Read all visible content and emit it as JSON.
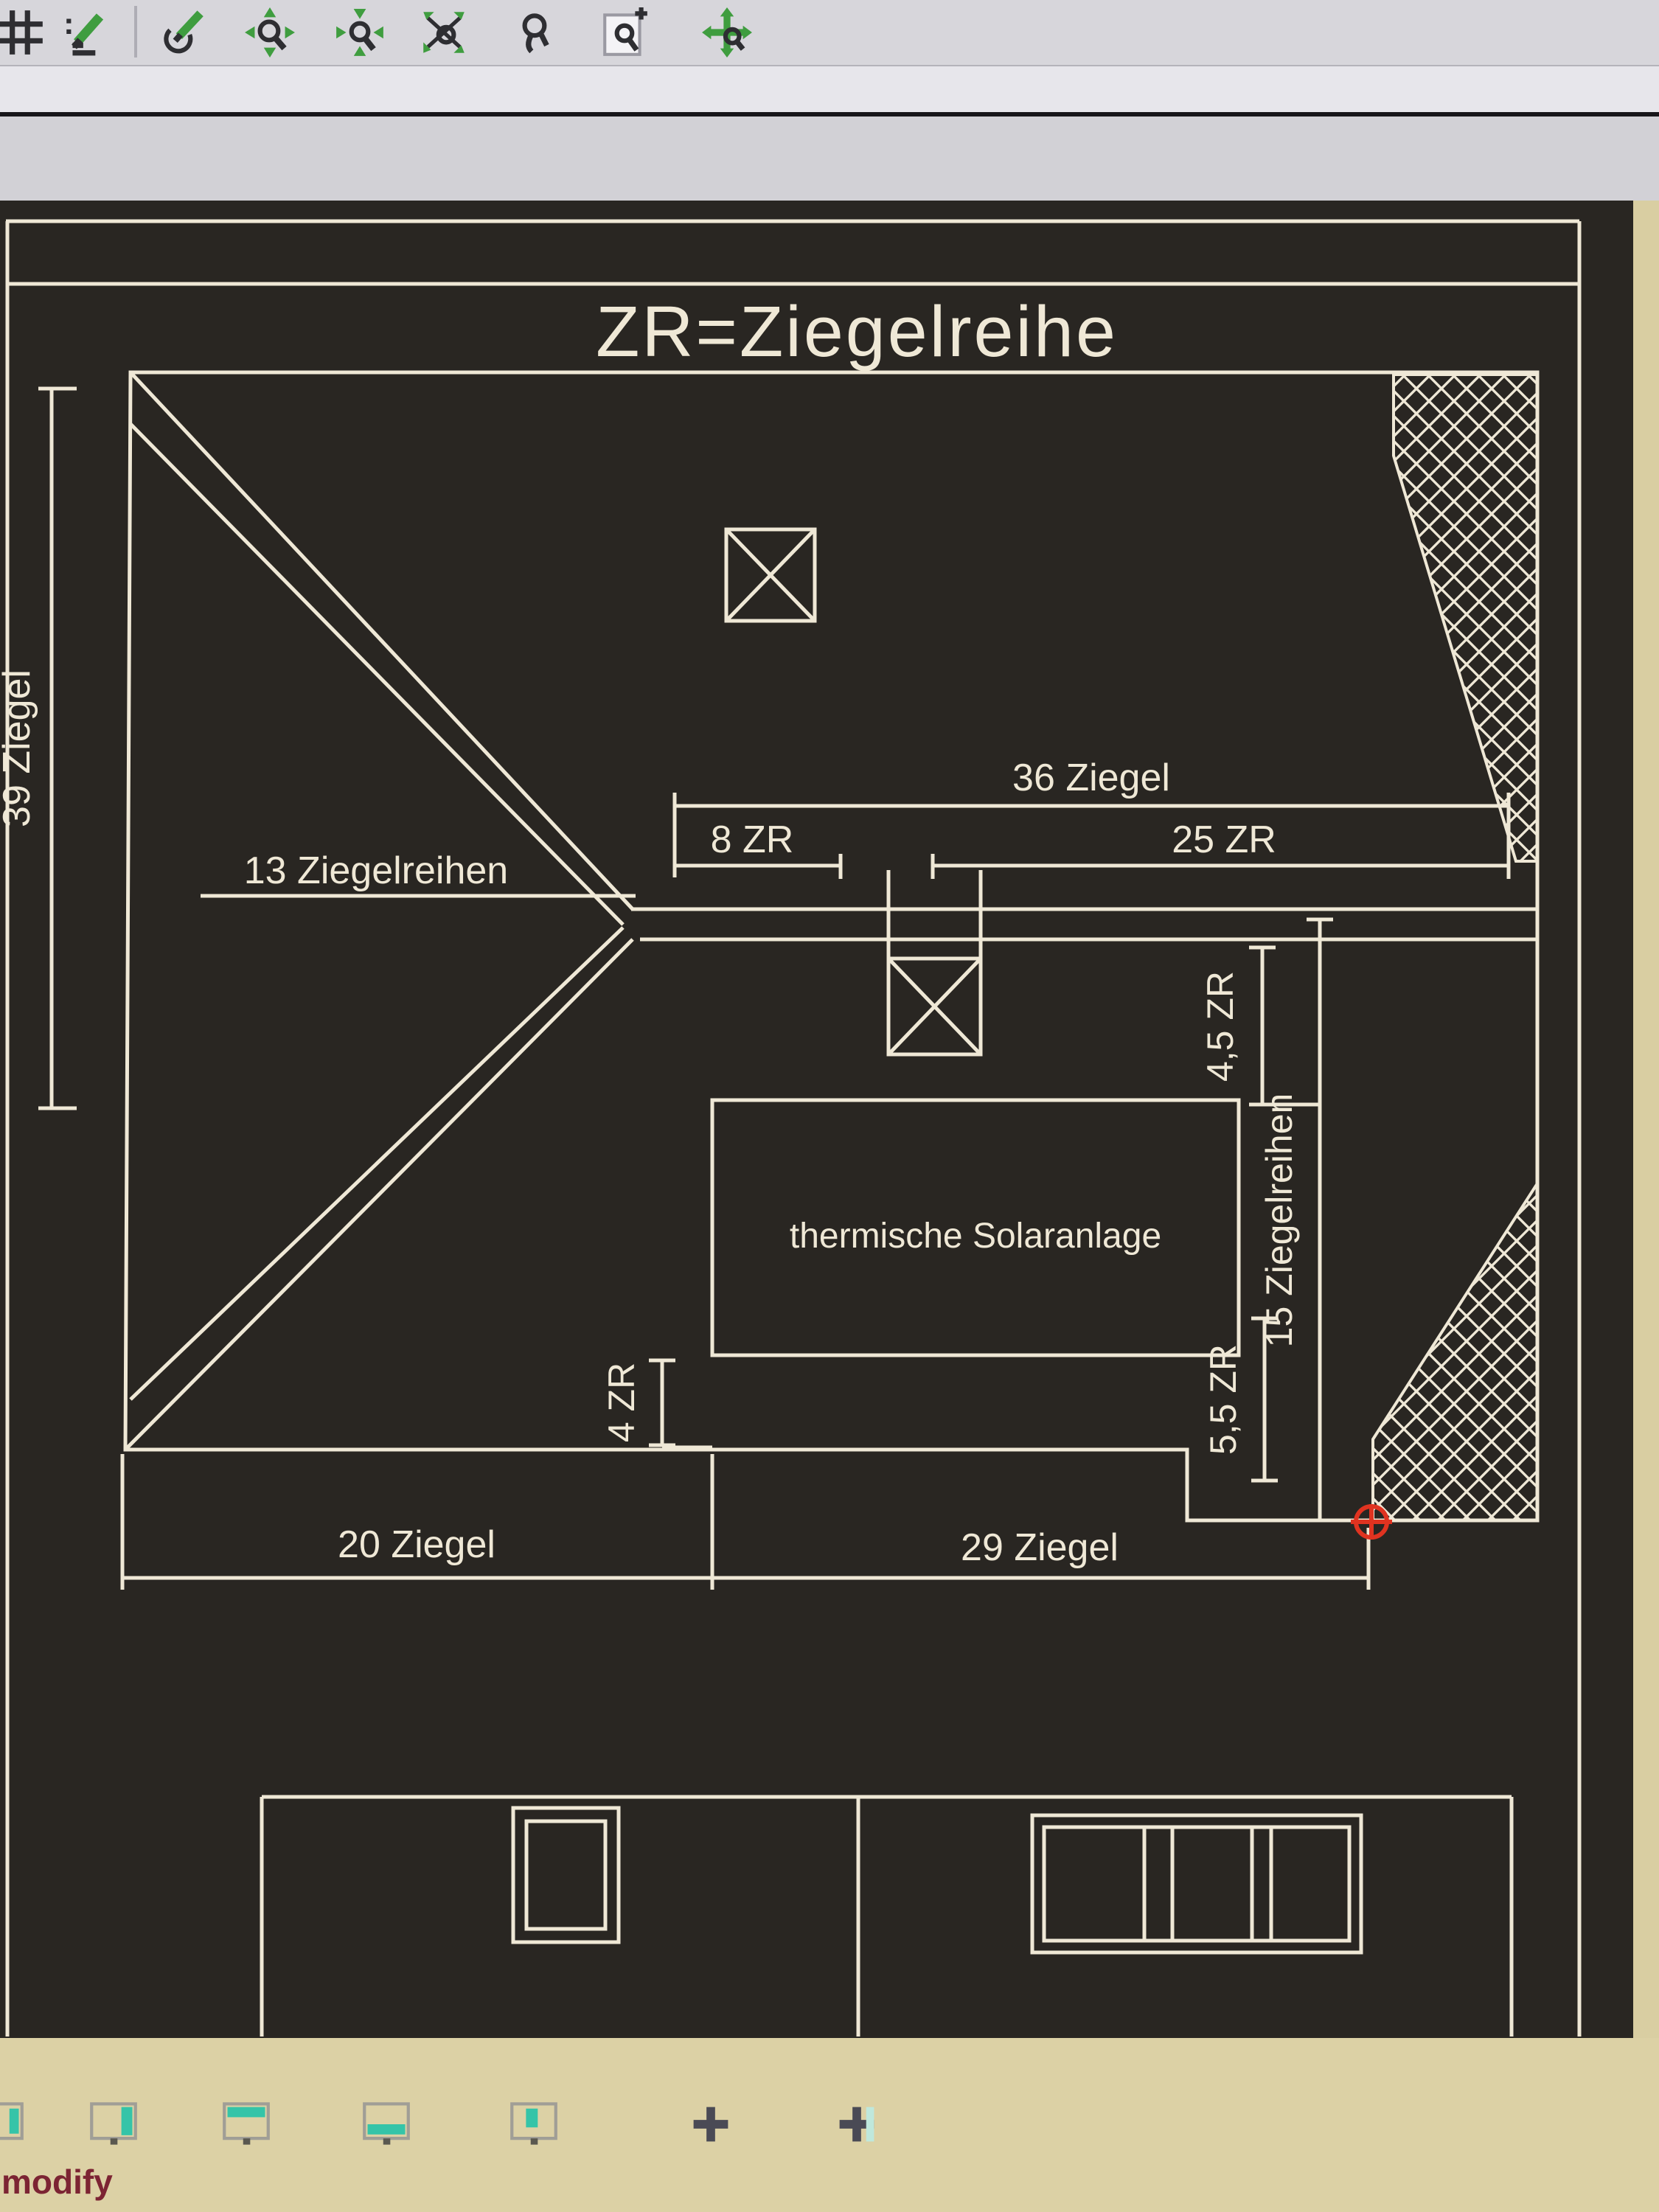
{
  "chrome": {
    "top_toolbar_icons": [
      "grid-icon",
      "sketch-line-icon",
      "pencil-arc-icon",
      "zoom-all-icon",
      "zoom-center-icon",
      "zoom-dynamic-icon",
      "zoom-realtime-icon",
      "zoom-window-icon",
      "pan-zoom-icon"
    ],
    "bottom_dock_icons": [
      "dock-partial-icon",
      "dock-right-icon",
      "dock-top-icon",
      "dock-bottom-icon",
      "dock-float-icon",
      "crosshair-plus-icon",
      "crosshair-plus-icon-2"
    ],
    "status_text": "modify"
  },
  "drawing": {
    "title": "ZR=Ziegelreihe",
    "labels": {
      "left_height": "39 Ziegel",
      "hip_rows": "13 Ziegelreihen",
      "top_width": "36 Ziegel",
      "ridge_left": "8 ZR",
      "ridge_right": "25 ZR",
      "right_upper": "4,5 ZR",
      "right_rows": "15 Ziegelreihen",
      "right_lower": "5,5 ZR",
      "solar_gap": "4 ZR",
      "solar_panel": "thermische Solaranlage",
      "bottom_left_width": "20 Ziegel",
      "bottom_right_width": "29 Ziegel"
    }
  },
  "colors": {
    "line": "#efe8d6",
    "canvas_bg": "#292622",
    "chrome_bg": "#d7d6db",
    "tan_bg": "#dcd1a5",
    "marker_red": "#e03320",
    "icon_green": "#3f9d3f",
    "status_text": "#7c2433",
    "teal_accent": "#35c4a8"
  }
}
